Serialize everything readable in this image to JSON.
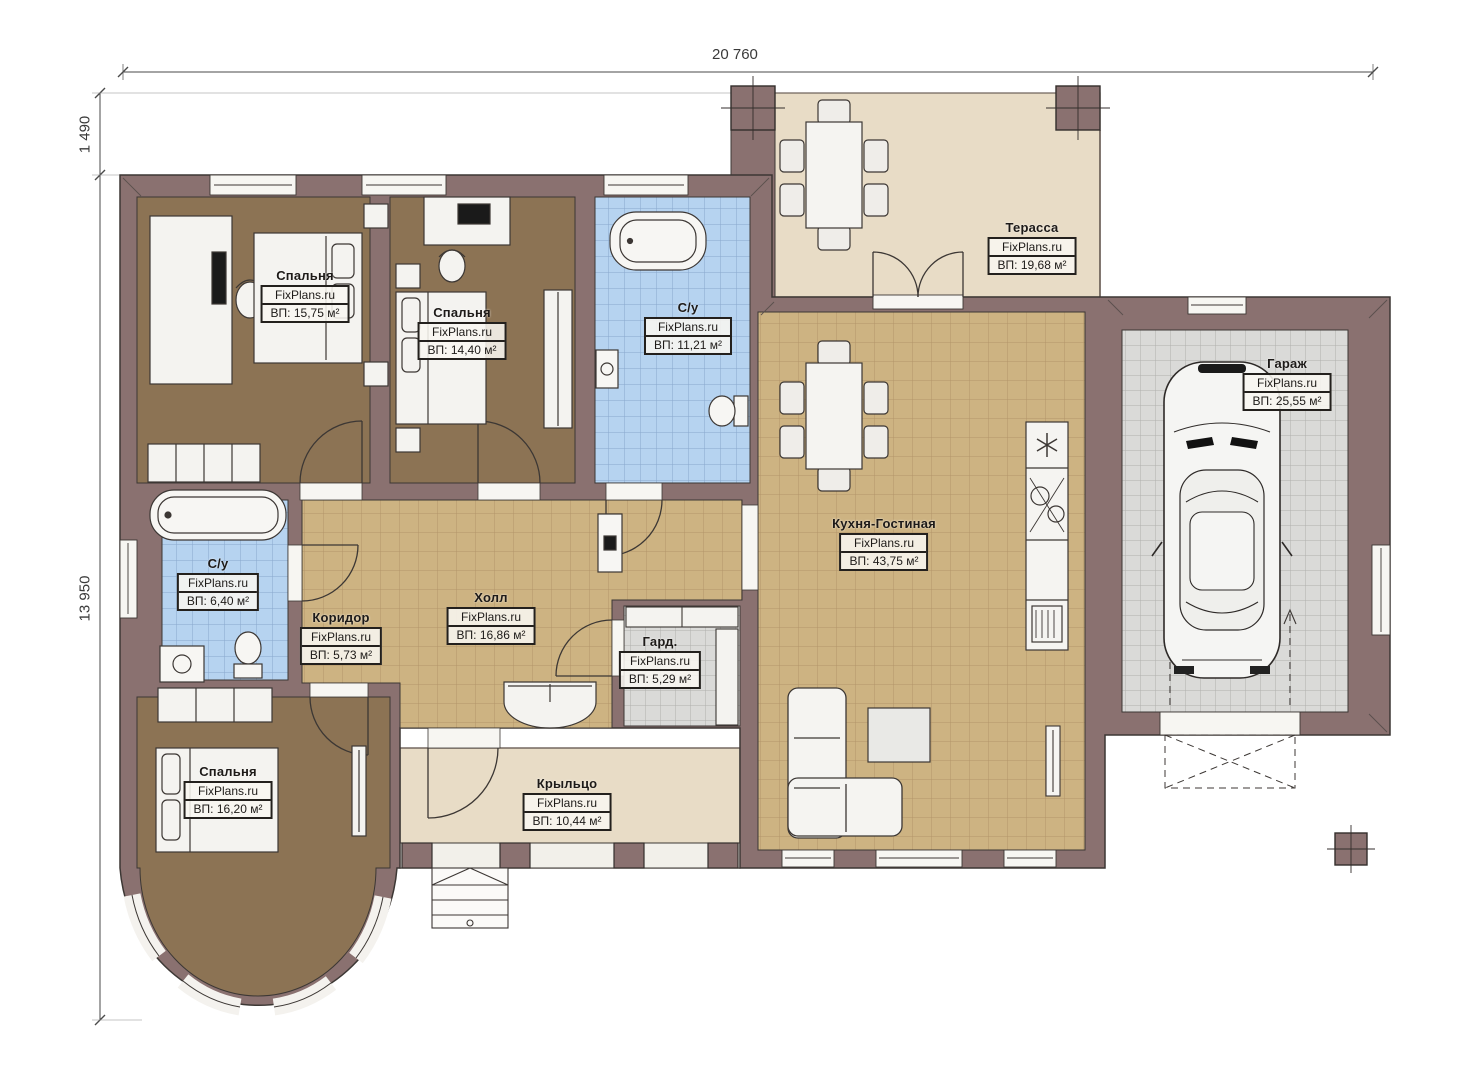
{
  "dimensions": {
    "top_width": "20 760",
    "left_upper": "1 490",
    "left_lower": "13 950"
  },
  "rooms": [
    {
      "name": "Спальня",
      "site": "FixPlans.ru",
      "area": "ВП: 15,75 м²"
    },
    {
      "name": "Спальня",
      "site": "FixPlans.ru",
      "area": "ВП: 14,40 м²"
    },
    {
      "name": "С/у",
      "site": "FixPlans.ru",
      "area": "ВП: 11,21 м²"
    },
    {
      "name": "Терасса",
      "site": "FixPlans.ru",
      "area": "ВП: 19,68 м²"
    },
    {
      "name": "Гараж",
      "site": "FixPlans.ru",
      "area": "ВП: 25,55 м²"
    },
    {
      "name": "Кухня-Гостиная",
      "site": "FixPlans.ru",
      "area": "ВП: 43,75 м²"
    },
    {
      "name": "Холл",
      "site": "FixPlans.ru",
      "area": "ВП: 16,86 м²"
    },
    {
      "name": "Гард.",
      "site": "FixPlans.ru",
      "area": "ВП: 5,29 м²"
    },
    {
      "name": "С/у",
      "site": "FixPlans.ru",
      "area": "ВП: 6,40 м²"
    },
    {
      "name": "Коридор",
      "site": "FixPlans.ru",
      "area": "ВП: 5,73 м²"
    },
    {
      "name": "Спальня",
      "site": "FixPlans.ru",
      "area": "ВП: 16,20 м²"
    },
    {
      "name": "Крыльцо",
      "site": "FixPlans.ru",
      "area": "ВП: 10,44 м²"
    }
  ],
  "colors": {
    "wall": "#8a7170",
    "wood_floor": "#8c7354",
    "tile_blue": "#b6d3f0",
    "tile_tan": "#cdb382",
    "tile_gray": "#dadad8",
    "terrace_floor": "#e8dcc6",
    "line": "#3c3734"
  }
}
